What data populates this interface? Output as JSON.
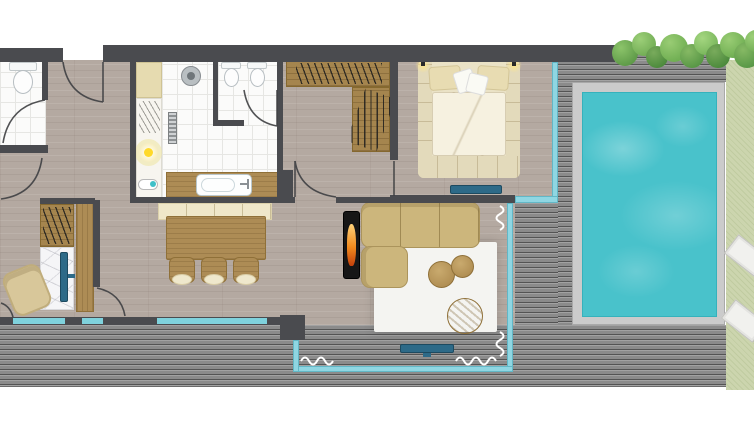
{
  "title": "Apartment floor plan with pool terrace",
  "rooms": {
    "entry": "Entry hall",
    "wc": "WC",
    "bathroom": "Bathroom",
    "guest_wc": "Guest WC",
    "dressing": "Dressing area",
    "bedroom": "Bedroom",
    "living": "Living room",
    "dining": "Dining area",
    "study": "Study nook",
    "terrace": "Terrace deck",
    "pool": "Pool",
    "garden": "Garden"
  },
  "colors": {
    "wall": "#4a4b4f",
    "floor_wood": "#b4a9a1",
    "tile": "#fbfbfa",
    "deck": "#8a8a8a",
    "pool_water": "#49c2cb",
    "pool_surround": "#cbcbcb",
    "glass": "#8fd6e2",
    "grass": "#ccd5ae",
    "tree_green": "#6fae52",
    "sofa_tan": "#ccb67c",
    "bed_cream": "#eae2c6",
    "furniture_wood": "#ad8c55",
    "tv_blue": "#2d6a88",
    "flame_orange": "#f08a1e",
    "rug_white": "#f4f4f1",
    "curtain_white": "#ffffff"
  }
}
